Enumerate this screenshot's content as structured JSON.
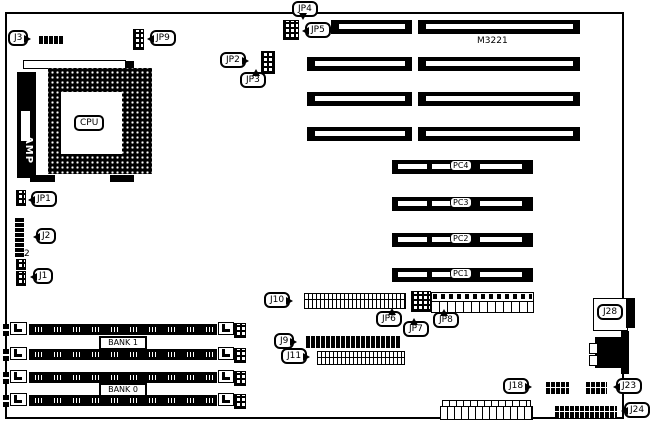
{
  "board": {
    "model": "M3221",
    "cpu": {
      "label": "CPU",
      "socket_maker": "AMP"
    },
    "jumper_labels": {
      "jp1": "JP1",
      "jp2": "JP2",
      "jp3": "JP3",
      "jp4": "JP4",
      "jp5": "JP5",
      "jp6": "JP6",
      "jp7": "JP7",
      "jp8": "JP8",
      "jp9": "JP9"
    },
    "connector_labels": {
      "j1": "J1",
      "j2": "J2",
      "j2_pin": "2",
      "j3": "J3",
      "j9": "J9",
      "j10": "J10",
      "j11": "J11",
      "j18": "J18",
      "j23": "J23",
      "j24": "J24",
      "j28": "J28"
    },
    "slot_labels": {
      "pc": [
        "PC4",
        "PC3",
        "PC2",
        "PC1"
      ]
    },
    "bank_labels": [
      "BANK 1",
      "BANK 0"
    ]
  }
}
